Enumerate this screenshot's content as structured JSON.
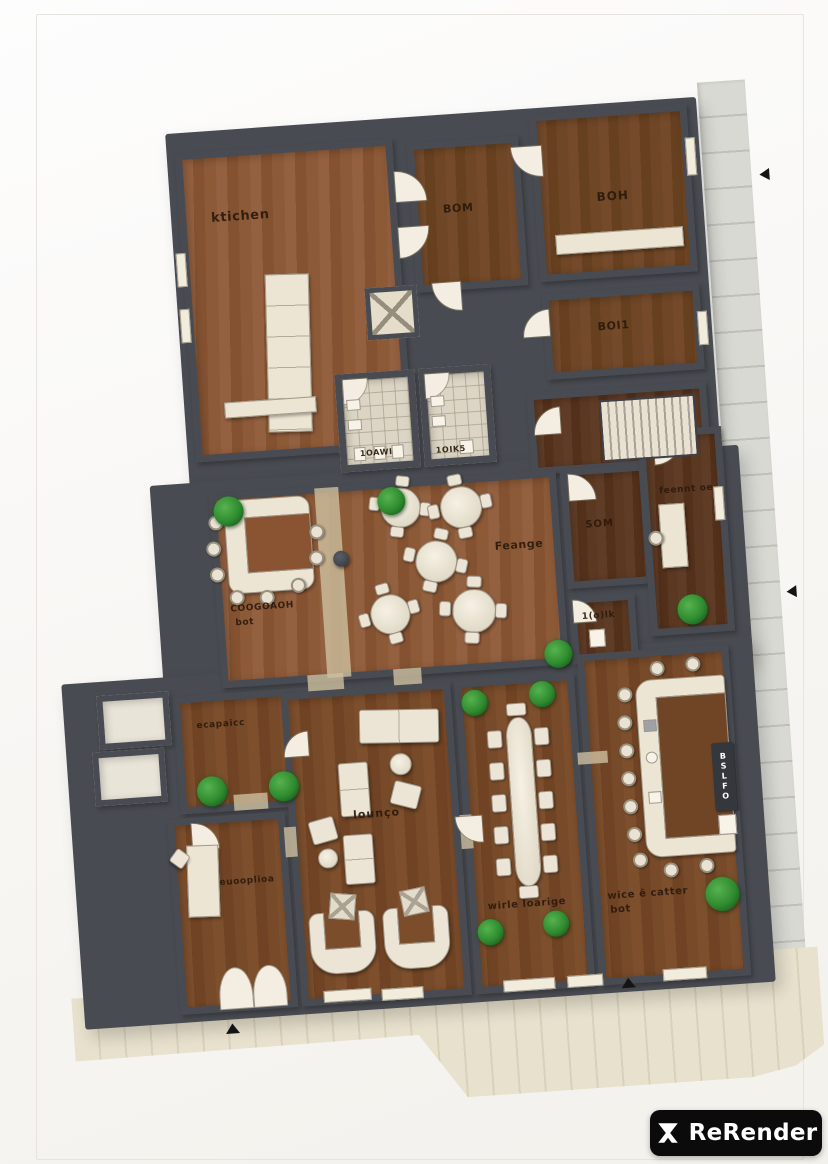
{
  "branding": {
    "watermark": "ReRender"
  },
  "rooms": {
    "kitchen": "ktichen",
    "boh_top_middle": "BOM",
    "boh_top_right": "BOH",
    "boh_right": "BOI1",
    "toilet_left": "1OAWI",
    "toilet_right": "1OIK5",
    "main_lounge": "Feange",
    "cocktail_bar_line1": "COOGOAOH",
    "cocktail_bar_line2": "bot",
    "som": "SOM",
    "office": "feennt oe",
    "small_wc": "1(o)lk",
    "staircase_room": "ecapaicc",
    "lounge": "lounço",
    "reception": "euooplioa",
    "wine_lounge": "wirle loarige",
    "wine_bar_line1": "wice ê catter",
    "wine_bar_line2": "bot",
    "bar_unit_vertical": "BSLFO"
  },
  "colors": {
    "wall": "#484b51",
    "wood_light": "#8d5a38",
    "wood_dark": "#5b3822",
    "furniture": "#ece5d5",
    "tile": "#dcd5c5",
    "plant_green": "#2e8b2e",
    "pavement": "#e8e1cd",
    "sidewalk": "#d9d9d3",
    "label_text": "#2b1a0c",
    "badge_bg": "#0b0b0b"
  }
}
